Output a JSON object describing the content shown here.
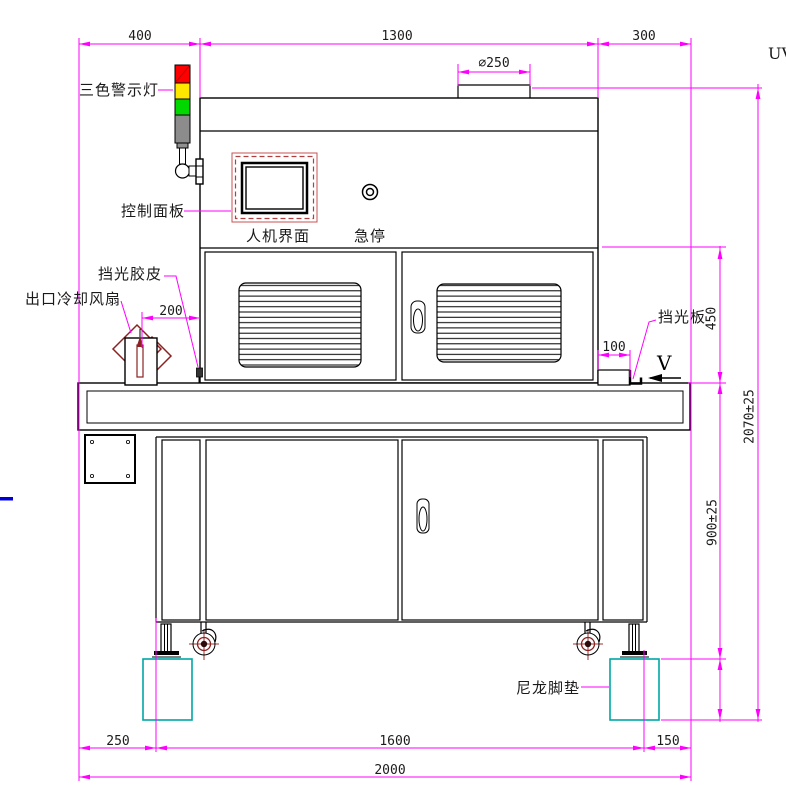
{
  "drawing": {
    "type": "engineering-drawing-front-view",
    "corner_text": "UV",
    "labels": {
      "warning_light": "三色警示灯",
      "control_panel": "控制面板",
      "hmi": "人机界面",
      "estop": "急停",
      "light_rubber": "挡光胶皮",
      "outlet_fan": "出口冷却风扇",
      "light_plate": "挡光板",
      "nylon_pad": "尼龙脚垫",
      "view_marker": "V"
    },
    "dimensions": {
      "top_left": "400",
      "top_mid": "1300",
      "top_right": "300",
      "duct_dia": "∅250",
      "fan_gap": "200",
      "plate_gap": "100",
      "upper_section_height": "450",
      "total_height": "2070±25",
      "lower_section_height": "900±25",
      "pad_height": "200",
      "bottom_left": "250",
      "bottom_mid": "1600",
      "bottom_right": "150",
      "bottom_total": "2000"
    },
    "colors": {
      "dimension_line": "#FF00FF",
      "lamp_red": "#FF0000",
      "lamp_yellow": "#FFE800",
      "lamp_green": "#00D800",
      "lamp_gray": "#8C8C8C",
      "accent_dark_red": "#8B2222",
      "pad_teal": "#00A6A6",
      "panel_red": "#C85050",
      "blue_mark": "#0000D6"
    }
  }
}
